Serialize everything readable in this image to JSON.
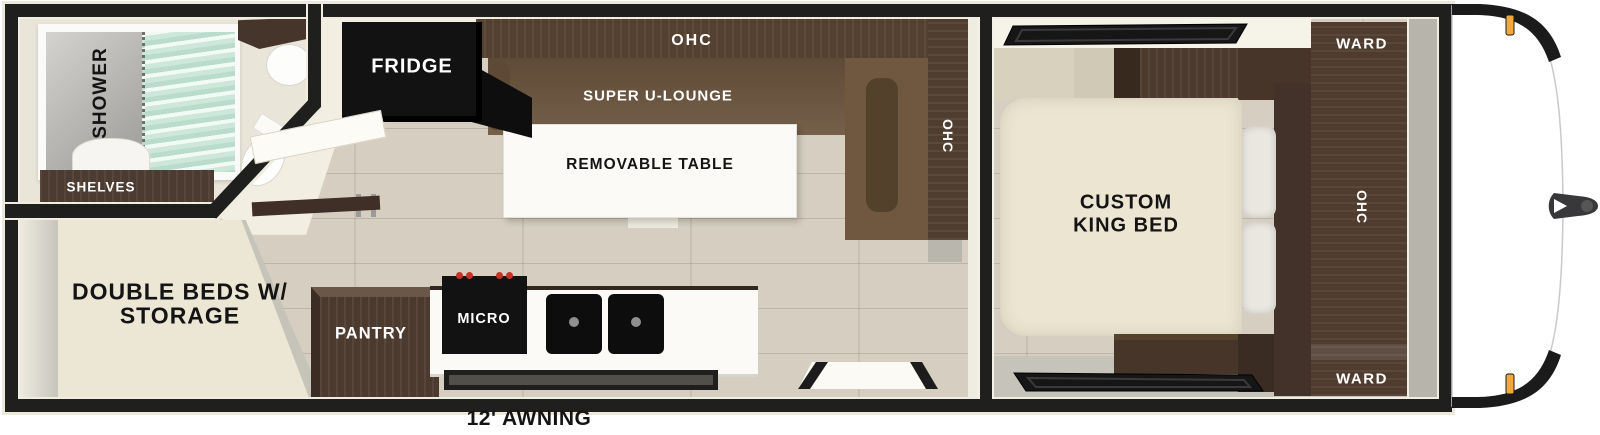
{
  "diagram_type": "rv-travel-trailer-floorplan",
  "awning": {
    "label": "12' AWNING"
  },
  "bathroom": {
    "shower_label": "SHOWER",
    "shelves_label": "SHELVES"
  },
  "rear_bedroom": {
    "beds_line1": "DOUBLE BEDS W/",
    "beds_line2": "STORAGE"
  },
  "kitchen": {
    "fridge_label": "FRIDGE",
    "pantry_label": "PANTRY",
    "micro_label": "MICRO"
  },
  "living": {
    "ohc_top_label": "OHC",
    "lounge_label": "SUPER U-LOUNGE",
    "table_label": "REMOVABLE TABLE",
    "ohc_side_label": "OHC"
  },
  "front_bedroom": {
    "bed_line1": "CUSTOM",
    "bed_line2": "KING BED",
    "ward_top_label": "WARD",
    "ohc_label": "OHC",
    "ward_bottom_label": "WARD"
  },
  "colors": {
    "wall": "#1f1f1e",
    "floor_wood": "#d6cfc1",
    "cabinet_dark": "#4c3a2e",
    "lounge_brown": "#705a40",
    "appliance_black": "#121212",
    "bed_cream": "#ece6d2",
    "counter_white": "#fbfaf6",
    "shower_curtain_teal": "#cde6d9",
    "marker_light_amber": "#efa93e"
  }
}
